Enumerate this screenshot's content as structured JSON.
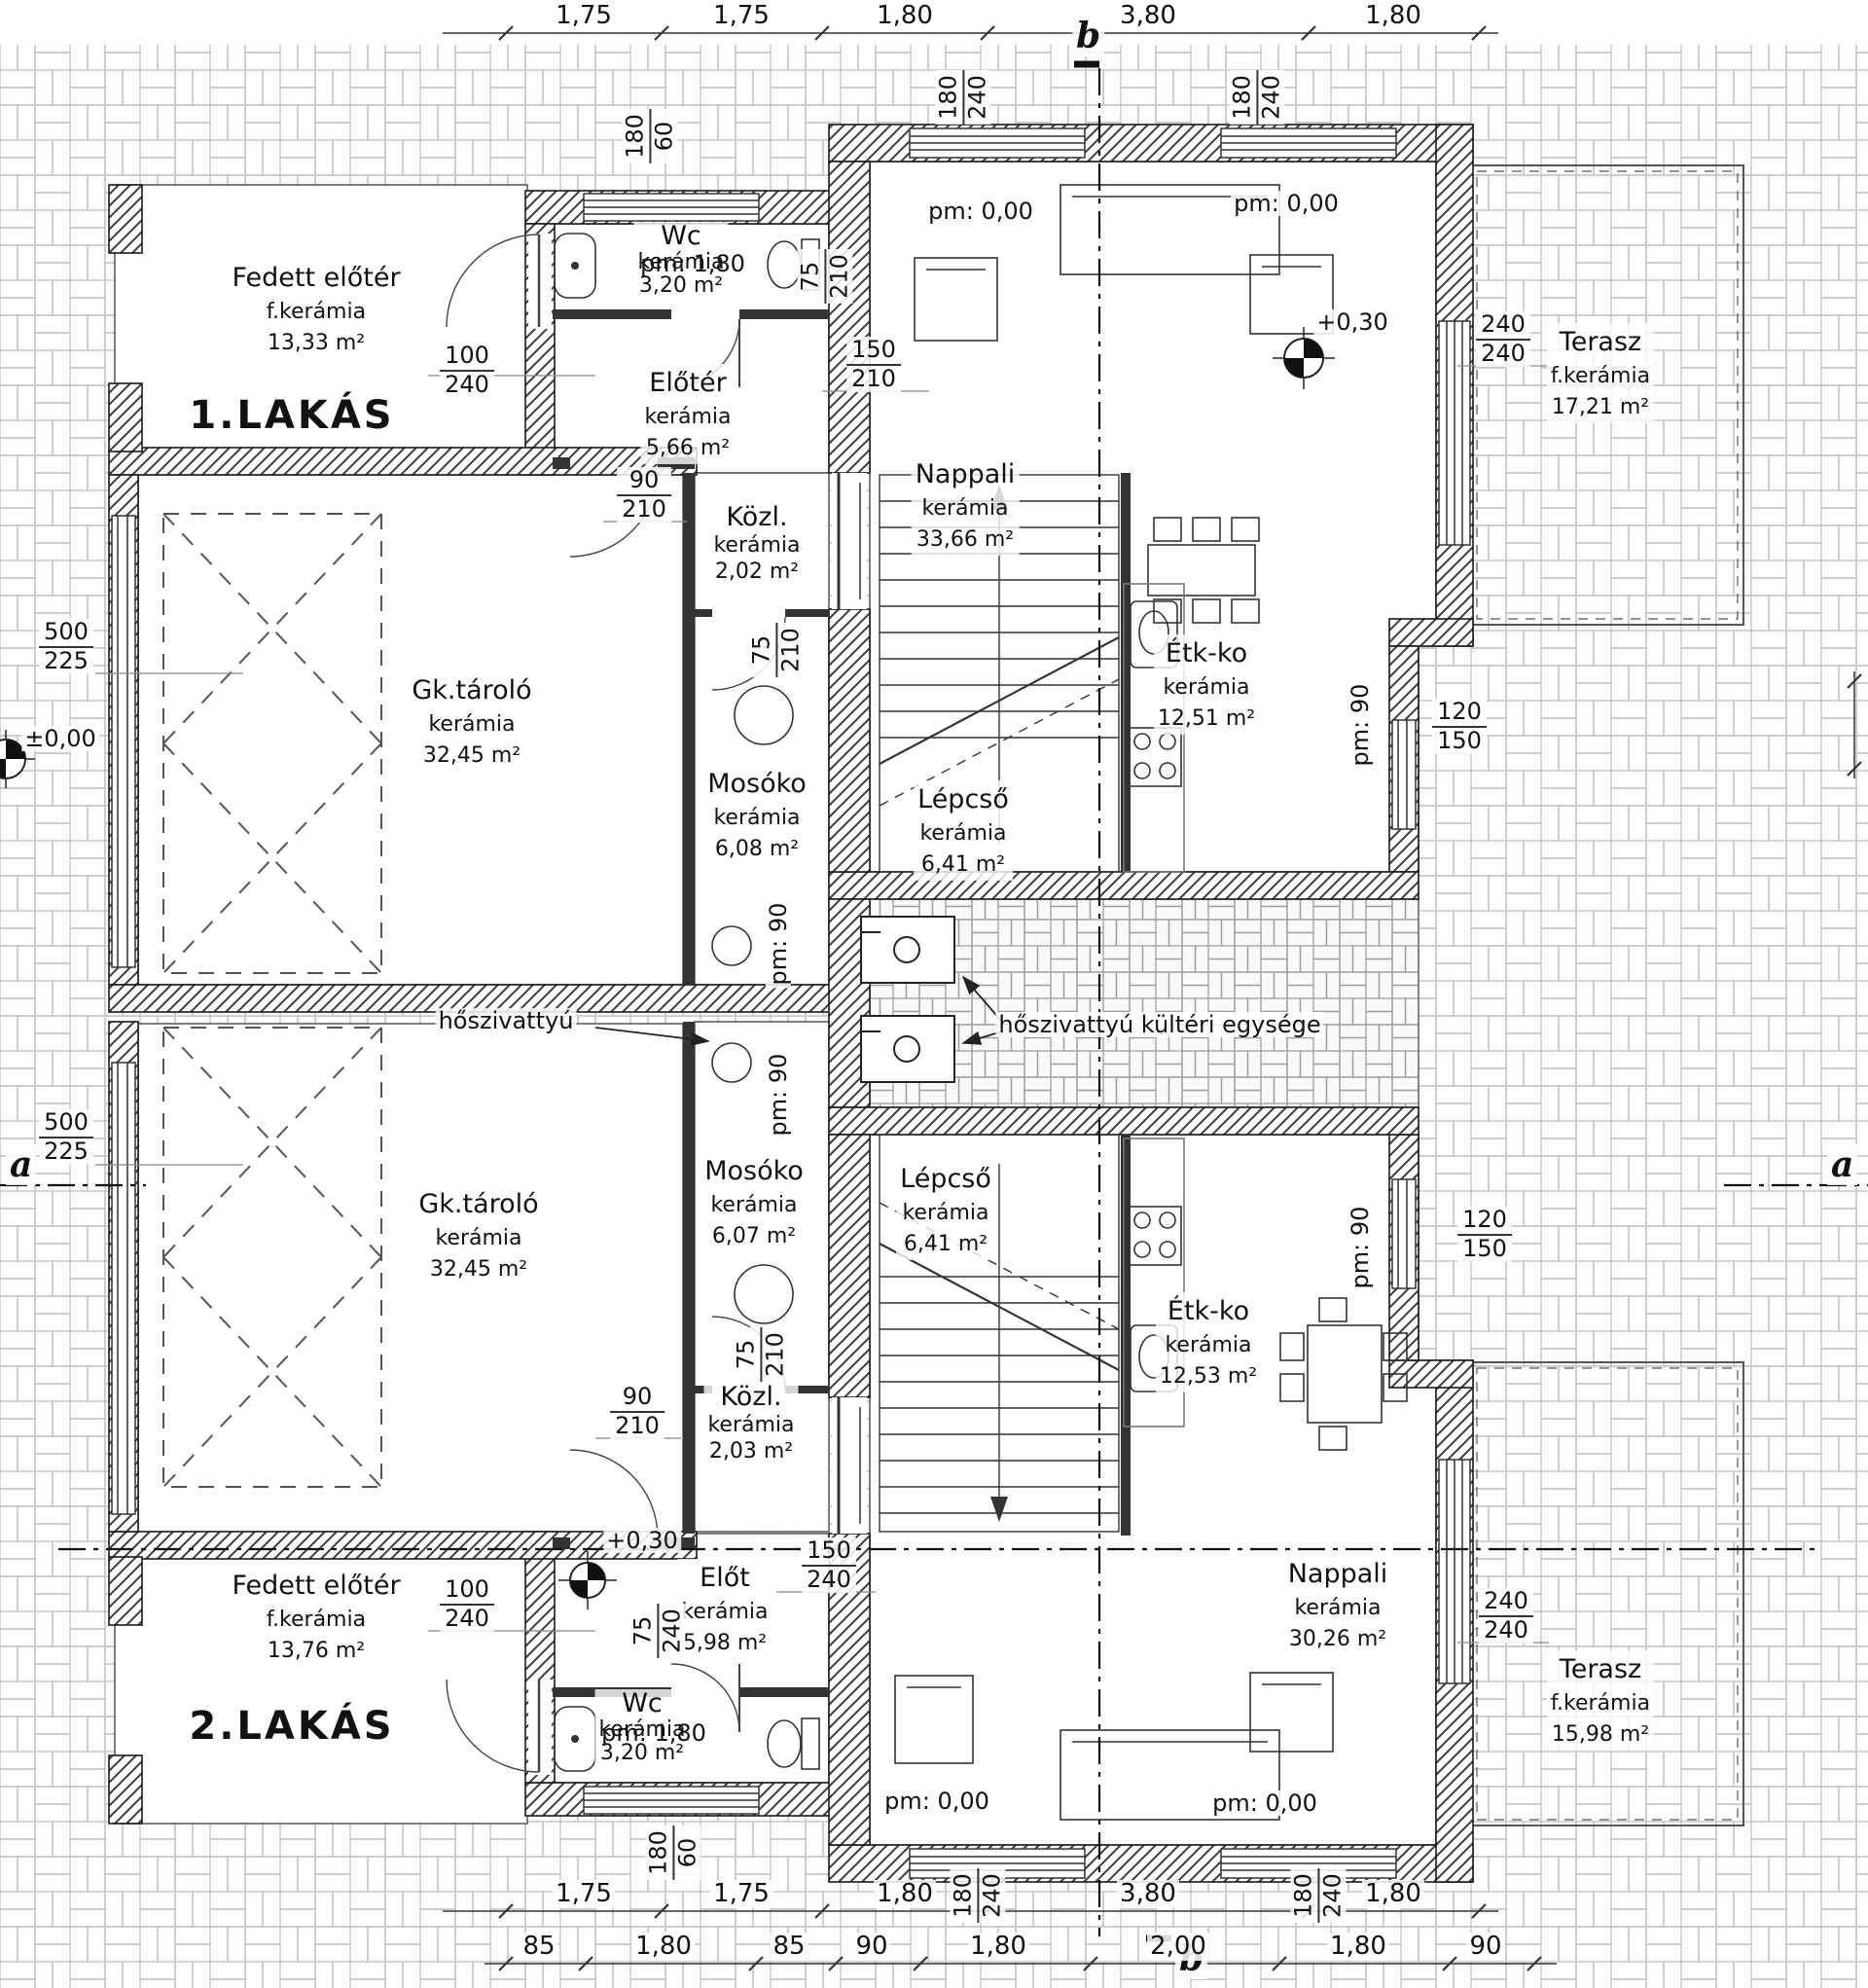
{
  "units": [
    {
      "label": "1.LAKÁS"
    },
    {
      "label": "2.LAKÁS"
    }
  ],
  "rooms": [
    {
      "name": "Fedett előtér",
      "material": "f.kerámia",
      "area": "13,33 m²"
    },
    {
      "name": "Wc",
      "material": "kerámia",
      "area": "3,20 m²"
    },
    {
      "name": "Előtér",
      "material": "kerámia",
      "area": "5,66 m²"
    },
    {
      "name": "Közl.",
      "material": "kerámia",
      "area": "2,02 m²"
    },
    {
      "name": "Gk.tároló",
      "material": "kerámia",
      "area": "32,45 m²"
    },
    {
      "name": "Mosóko",
      "material": "kerámia",
      "area": "6,08 m²"
    },
    {
      "name": "Lépcső",
      "material": "kerámia",
      "area": "6,41 m²"
    },
    {
      "name": "Nappali",
      "material": "kerámia",
      "area": "33,66 m²"
    },
    {
      "name": "Étk-ko",
      "material": "kerámia",
      "area": "12,51 m²"
    },
    {
      "name": "Terasz",
      "material": "f.kerámia",
      "area": "17,21 m²"
    },
    {
      "name": "Gk.tároló",
      "material": "kerámia",
      "area": "32,45 m²"
    },
    {
      "name": "Mosóko",
      "material": "kerámia",
      "area": "6,07 m²"
    },
    {
      "name": "Lépcső",
      "material": "kerámia",
      "area": "6,41 m²"
    },
    {
      "name": "Közl.",
      "material": "kerámia",
      "area": "2,03 m²"
    },
    {
      "name": "Előt",
      "material": "kerámia",
      "area": "5,98 m²"
    },
    {
      "name": "Wc",
      "material": "kerámia",
      "area": "3,20 m²"
    },
    {
      "name": "Fedett előtér",
      "material": "f.kerámia",
      "area": "13,76 m²"
    },
    {
      "name": "Nappali",
      "material": "kerámia",
      "area": "30,26 m²"
    },
    {
      "name": "Étk-ko",
      "material": "kerámia",
      "area": "12,53 m²"
    },
    {
      "name": "Terasz",
      "material": "f.kerámia",
      "area": "15,98 m²"
    }
  ],
  "levels": {
    "pm_000": "pm: 0,00",
    "plus_030": "+0,30",
    "zero_00": "±0,00",
    "pm_90": "pm: 90",
    "pm_180": "pm: 1,80"
  },
  "annotations": {
    "heat_pump": "hőszivattyú",
    "heat_pump_outdoor": "hőszivattyú kültéri egysége"
  },
  "sections": {
    "a": "a",
    "b": "b"
  },
  "dims": {
    "top": [
      "1,75",
      "1,75",
      "1,80",
      "3,80",
      "1,80"
    ],
    "bottom_upper": [
      "1,75",
      "1,75",
      "1,80",
      "3,80",
      "1,80"
    ],
    "bottom_lower": [
      "85",
      "1,80",
      "85",
      "90",
      "1,80",
      "2,00",
      "1,80",
      "90"
    ]
  },
  "dim_fractions": [
    {
      "num": "100",
      "den": "240"
    },
    {
      "num": "90",
      "den": "210"
    },
    {
      "num": "150",
      "den": "210"
    },
    {
      "num": "75",
      "den": "210"
    },
    {
      "num": "240",
      "den": "240"
    },
    {
      "num": "120",
      "den": "150"
    },
    {
      "num": "500",
      "den": "225"
    },
    {
      "num": "500",
      "den": "225"
    },
    {
      "num": "180",
      "den": "60"
    },
    {
      "num": "180",
      "den": "240"
    },
    {
      "num": "180",
      "den": "240"
    },
    {
      "num": "100",
      "den": "240"
    },
    {
      "num": "90",
      "den": "210"
    },
    {
      "num": "150",
      "den": "240"
    },
    {
      "num": "75",
      "den": "210"
    },
    {
      "num": "240",
      "den": "240"
    },
    {
      "num": "120",
      "den": "150"
    },
    {
      "num": "180",
      "den": "60"
    },
    {
      "num": "180",
      "den": "240"
    },
    {
      "num": "180",
      "den": "240"
    },
    {
      "num": "75",
      "den": "210"
    },
    {
      "num": "75",
      "den": "240"
    }
  ]
}
